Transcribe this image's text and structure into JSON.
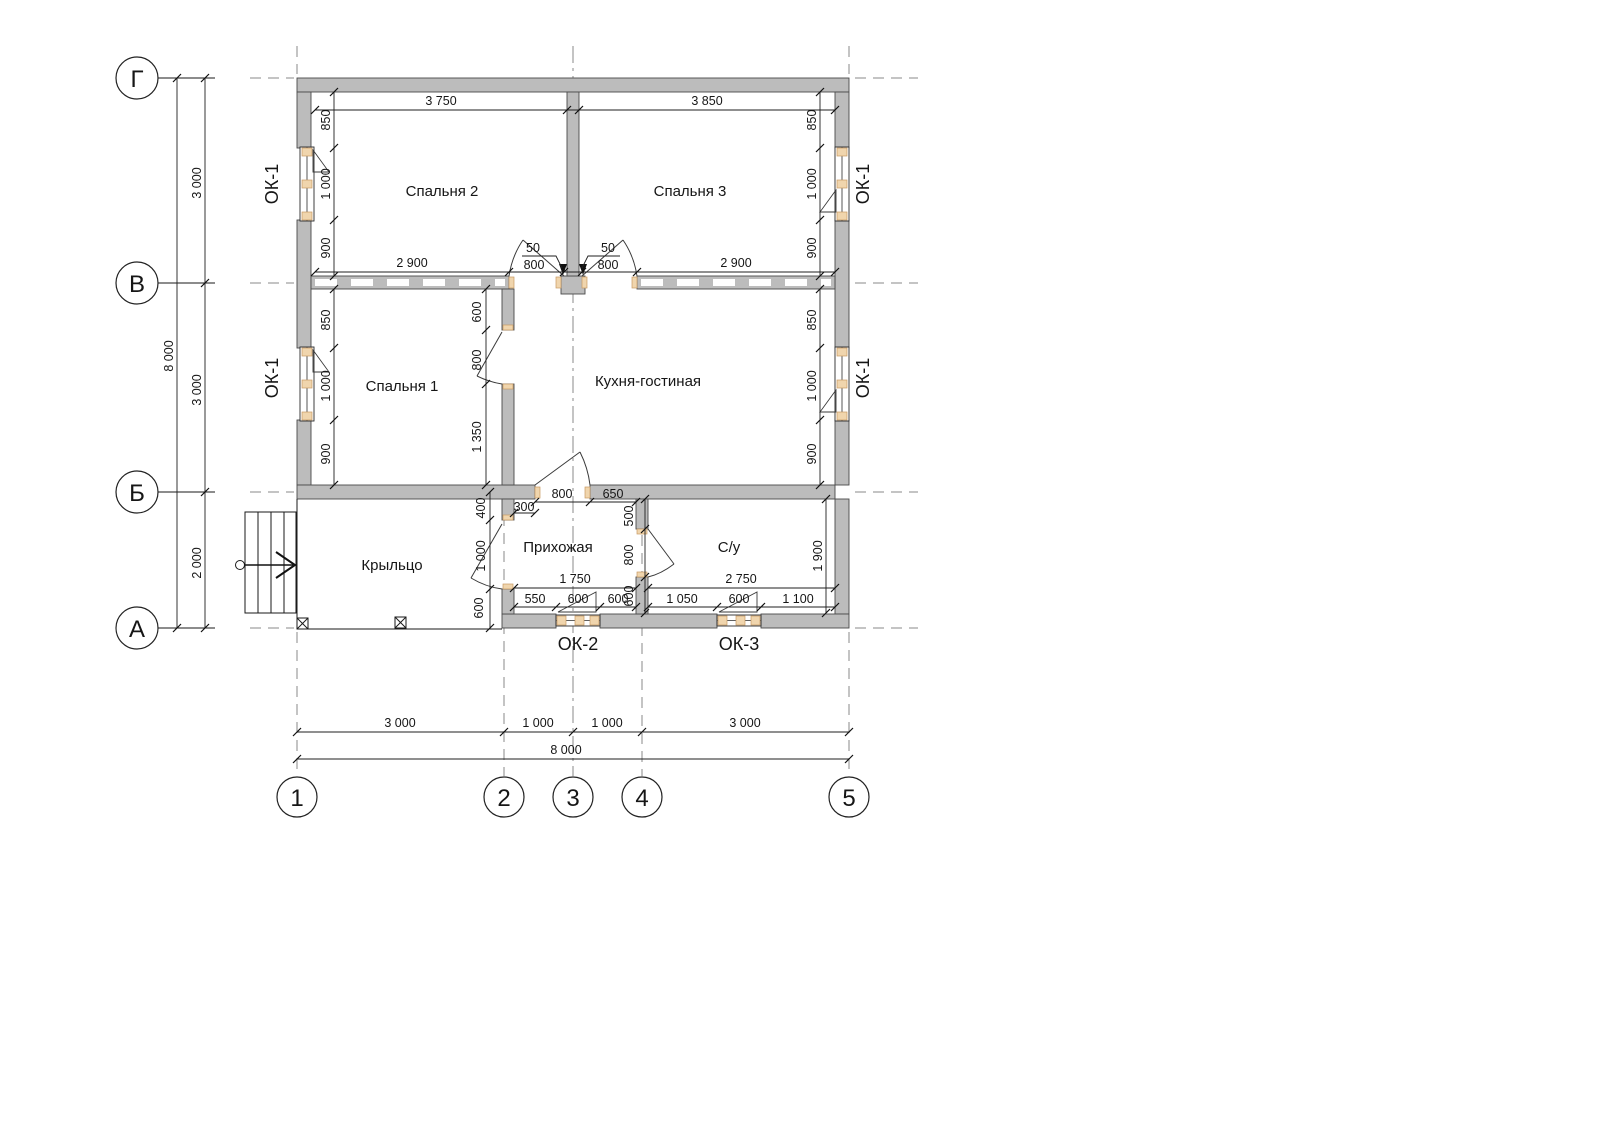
{
  "drawing": {
    "axis_rows": [
      "Г",
      "В",
      "Б",
      "А"
    ],
    "axis_cols": [
      "1",
      "2",
      "3",
      "4",
      "5"
    ],
    "rooms": [
      "Спальня 2",
      "Спальня 3",
      "Спальня 1",
      "Кухня-гостиная",
      "Прихожая",
      "С/у",
      "Крыльцо"
    ],
    "window_marks": {
      "ok1": "ОК-1",
      "ok2": "ОК-2",
      "ok3": "ОК-3"
    },
    "dims": {
      "grid_left": [
        "3 000",
        "3 000",
        "2 000",
        "8 000"
      ],
      "grid_bottom": [
        "3 000",
        "1 000",
        "1 000",
        "3 000",
        "8 000"
      ],
      "top": [
        "3 750",
        "3 850"
      ],
      "bedroom_bottom": [
        "2 900",
        "50",
        "800",
        "50",
        "800",
        "2 900"
      ],
      "wall_left": [
        "850",
        "1 000",
        "900",
        "850",
        "1 000",
        "900"
      ],
      "wall_right": [
        "850",
        "1 000",
        "900",
        "850",
        "1 000",
        "900"
      ],
      "bedroom1_wall": [
        "600",
        "800",
        "1 350"
      ],
      "hall_left": [
        "400",
        "1 000",
        "600"
      ],
      "hall_top": [
        "800",
        "650",
        "300"
      ],
      "bath_wall": [
        "500",
        "800",
        "600"
      ],
      "hall_bottom": [
        "1 750",
        "550",
        "600",
        "600"
      ],
      "bath_bottom": [
        "2 750",
        "1 050",
        "600",
        "1 100"
      ],
      "bath_height": "1 900"
    },
    "colors": {
      "wall_fill": "#bcbcbc",
      "wall_stroke": "#4a4a4a",
      "window_accent": "#f0d5ad",
      "line": "#1a1a1a"
    }
  }
}
